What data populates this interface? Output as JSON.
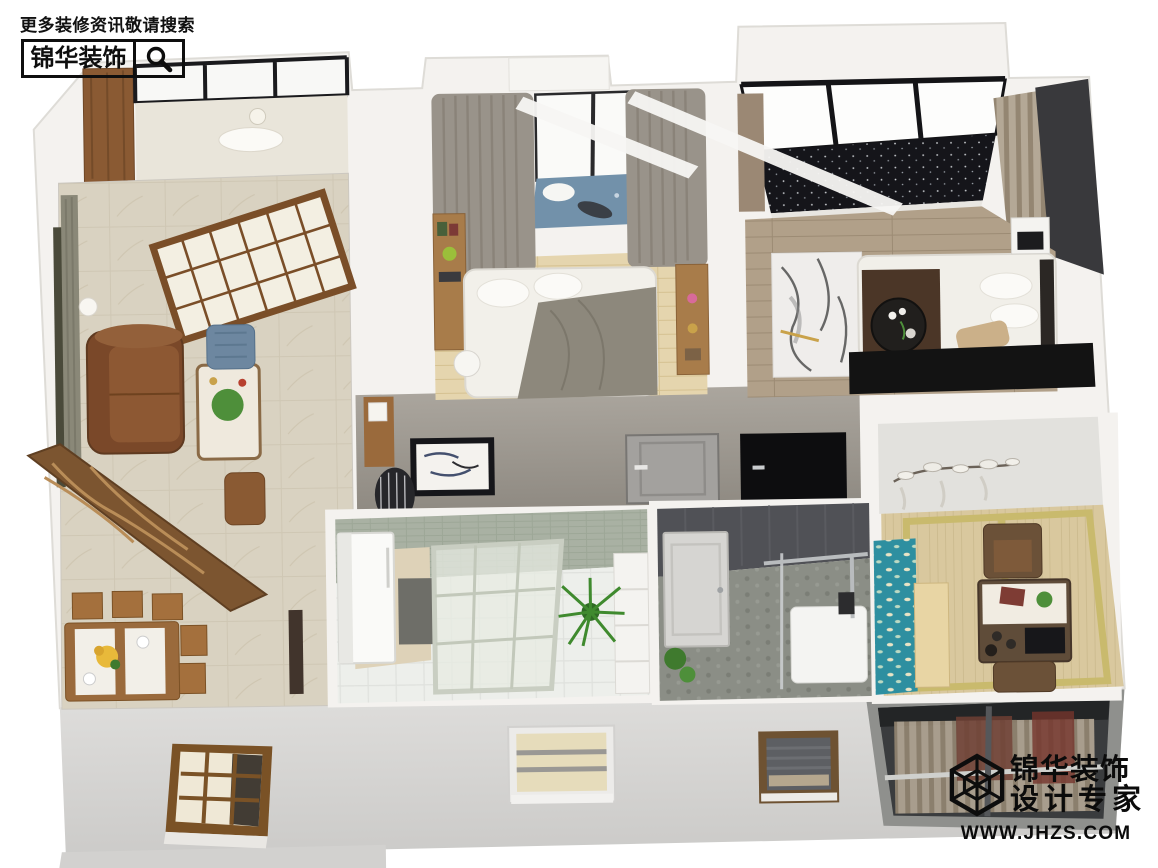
{
  "page": {
    "width": 1158,
    "height": 868,
    "background": "#ffffff"
  },
  "watermark_top_left": {
    "tagline": "更多装修资讯敬请搜索",
    "brand": "锦华装饰",
    "icon": "magnifier-icon"
  },
  "watermark_bottom_right": {
    "brand": "锦华装饰",
    "subtitle": "设计专家",
    "url": "WWW.JHZS.COM",
    "icon": "lattice-cube-logo"
  },
  "scene": {
    "kind": "3d-isometric-apartment-cutaway-render",
    "rooms": [
      {
        "name": "balcony-sunroom",
        "position": "top-left",
        "floor_color": "#e9e5da",
        "features": [
          "black-frame-windows",
          "wood-cabinet",
          "round-table"
        ]
      },
      {
        "name": "living-room",
        "position": "left",
        "floor_color": "#d9d2c1",
        "features": [
          "brown-leather-sofa",
          "marble-coffee-table",
          "blue-accent-chair",
          "gray-green-curtains",
          "wood-french-doors",
          "carved-wood-screen",
          "floor-lamps"
        ]
      },
      {
        "name": "dining-area",
        "position": "bottom-left",
        "floor_color": "#d9d2c1",
        "features": [
          "wood-dining-table",
          "white-runner",
          "sunflower-bouquet",
          "wood-chairs"
        ]
      },
      {
        "name": "bedroom",
        "position": "top-center",
        "floor_color": "#e5d5ae",
        "features": [
          "double-bed",
          "bay-window-blue-seat",
          "taupe-curtains",
          "wall-shelf-desk",
          "round-floor-lamp"
        ]
      },
      {
        "name": "master-bedroom",
        "position": "top-right",
        "floor_color": "#b1a089",
        "features": [
          "floor-to-ceiling-black-windows",
          "speckled-balcony-floor",
          "marble-rug",
          "white-bed-brown-runner",
          "round-black-table",
          "tv-console",
          "dark-accent-wall"
        ]
      },
      {
        "name": "hallway",
        "position": "center",
        "wall_color": "#9e9992",
        "features": [
          "framed-ink-artwork",
          "striped-drum-stool",
          "gray-interior-door",
          "dark-doorway"
        ]
      },
      {
        "name": "kitchen",
        "position": "bottom-center-left",
        "wall_color": "#a9b1a3",
        "floor_color": "#edefeb",
        "features": [
          "white-refrigerator",
          "sliding-glass-partition",
          "potted-plant",
          "white-shelf"
        ]
      },
      {
        "name": "bathroom",
        "position": "bottom-center-right",
        "wall_color": "#505156",
        "floor_color": "#8b8e86",
        "features": [
          "white-panel-door",
          "glass-shower-screen",
          "white-shower-tray",
          "green-plant"
        ]
      },
      {
        "name": "tea-room",
        "position": "bottom-right",
        "floor_color": "#d9c89e",
        "features": [
          "tatami-mats",
          "teal-fish-rug",
          "wood-bench",
          "tea-table-with-stove",
          "upholstered-chairs",
          "flower-wall-decor"
        ]
      }
    ],
    "facade": {
      "band_color": "#d7d6d4",
      "windows": [
        "wood-grid-window",
        "lit-center-window",
        "brown-frame-blind-window",
        "recessed-balcony-striped-curtains"
      ]
    },
    "palette": {
      "outer_wall": "#f4f2ef",
      "wall_edge": "#dedcd7",
      "facade_gray": "#d7d6d4",
      "wood_accent": "#8a5a33",
      "sofa_brown": "#7a4829",
      "curtain_taupe": "#99938a",
      "tatami_tan": "#d9c89e",
      "rug_teal": "#2e8fa0",
      "window_black": "#17171a",
      "logo_black": "#0e0e0e"
    }
  }
}
